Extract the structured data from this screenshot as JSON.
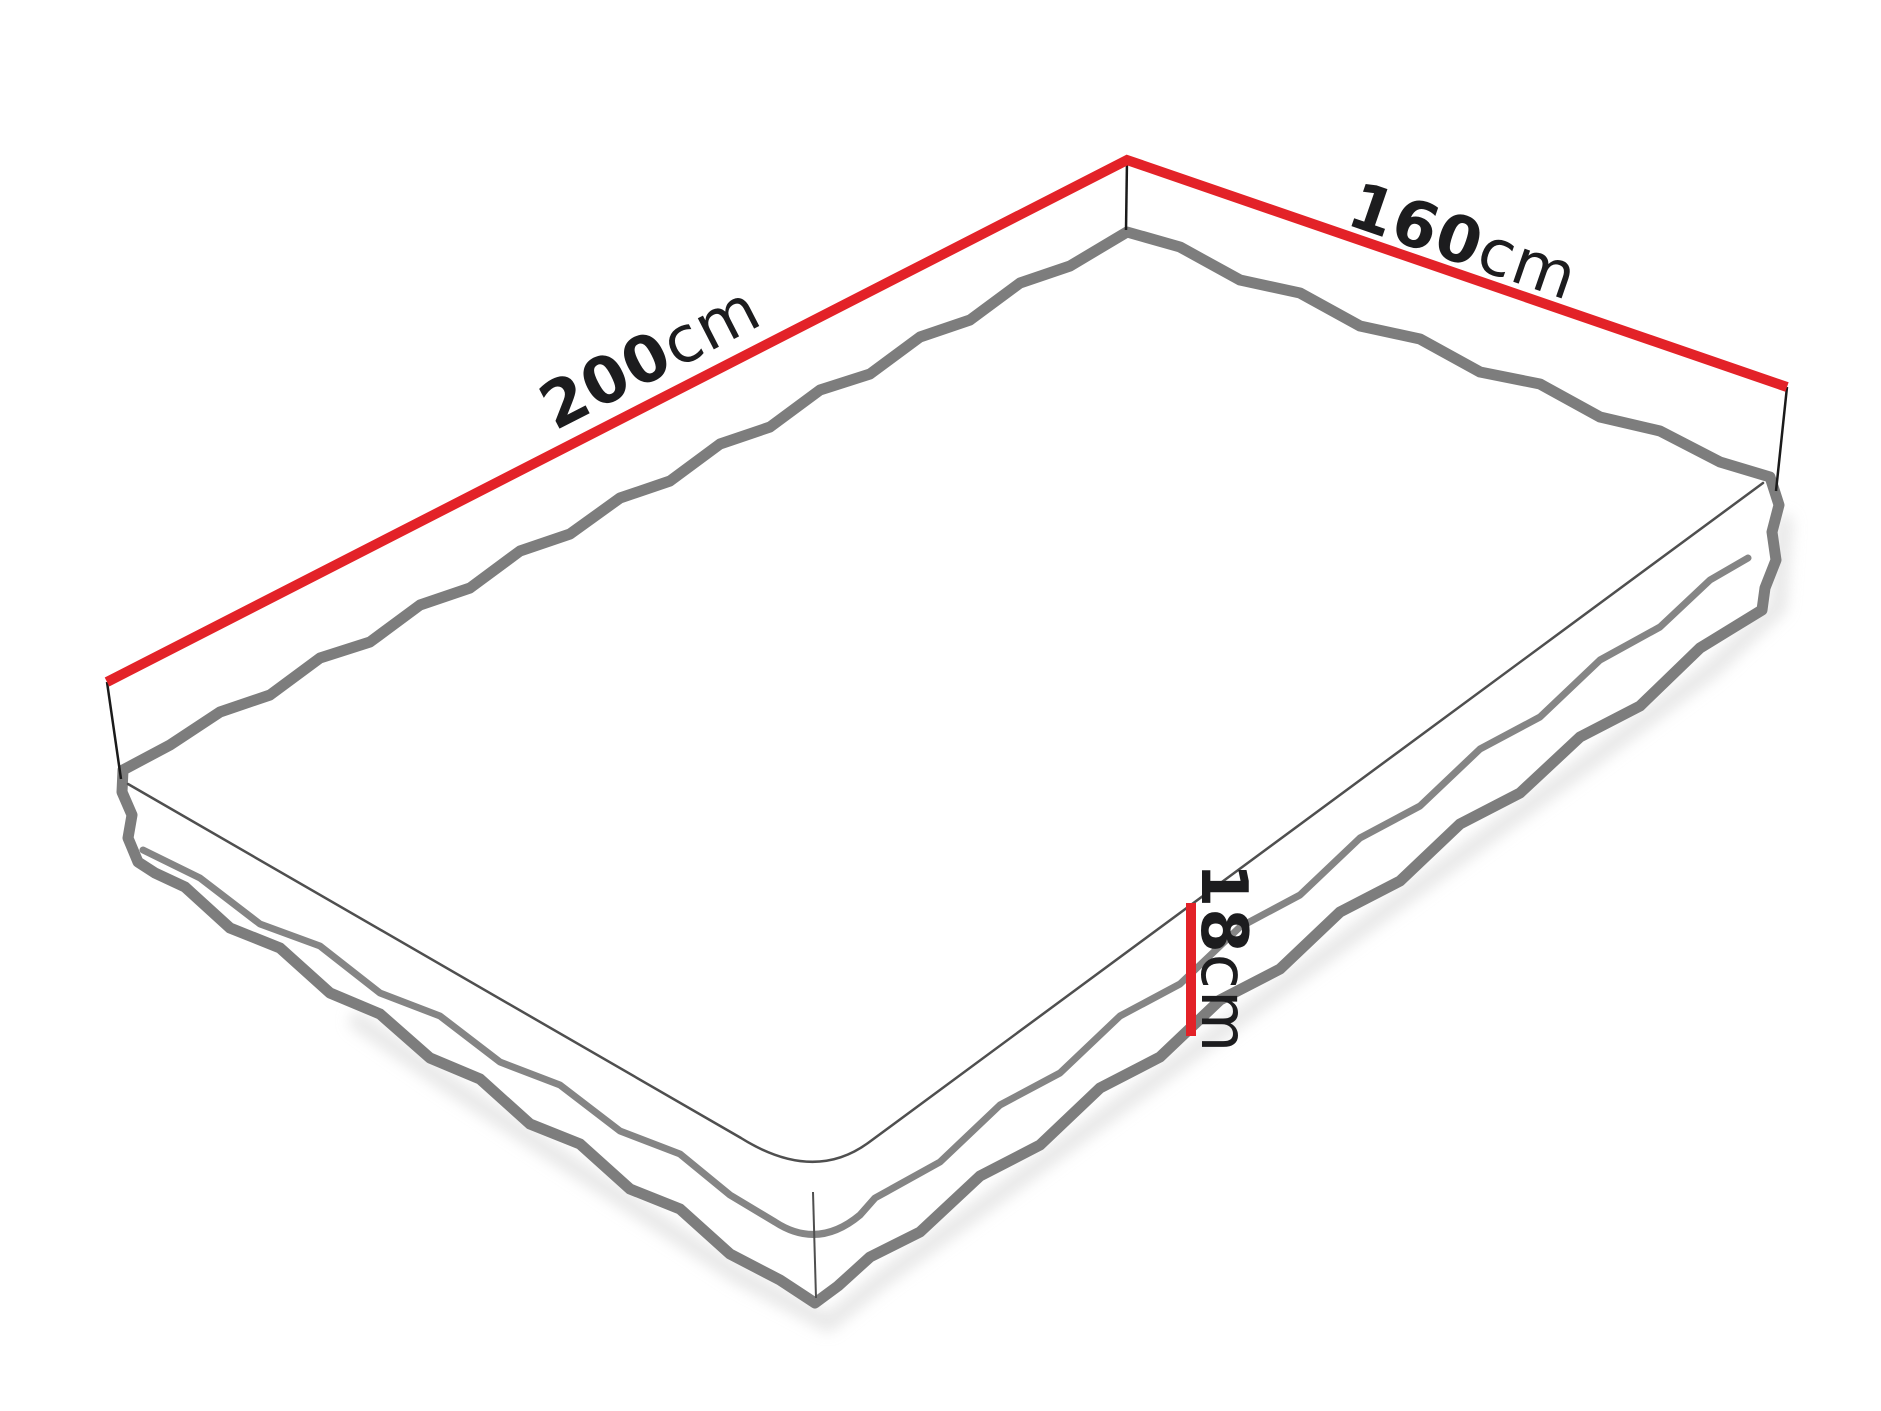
{
  "diagram": {
    "subject": "mattress-dimensions",
    "dimensions": {
      "length": {
        "value": "200",
        "unit": "cm"
      },
      "width": {
        "value": "160",
        "unit": "cm"
      },
      "height": {
        "value": "18",
        "unit": "cm"
      }
    }
  },
  "colors": {
    "dimension_line_red": "#e32228",
    "piping_gray": "#7d7d7d",
    "mid_piping_gray": "#858585",
    "edge_line_gray": "#4f4f4f",
    "extension_line_black": "#1a1a1a",
    "label_text_black": "#1c1c1e",
    "shadow_gray": "#d6d6d6",
    "background_white": "#ffffff"
  }
}
